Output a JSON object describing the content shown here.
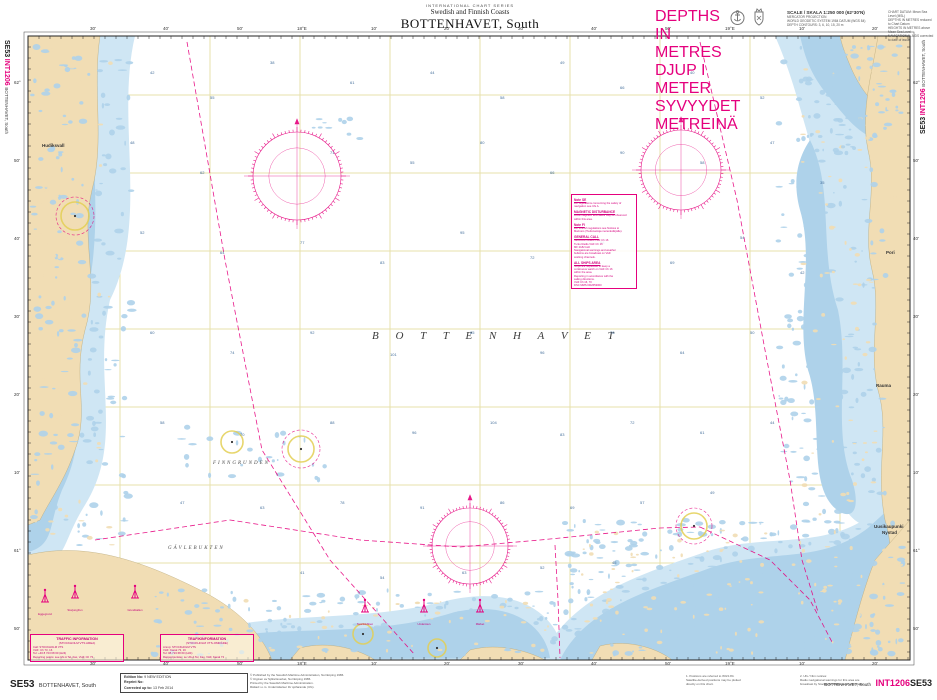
{
  "colors": {
    "magenta": "#e5007d",
    "land": "#f1ddb4",
    "shallow": "#aed2ea",
    "shallow_light": "#cfe6f4",
    "yellow": "#e3cf54",
    "graticule": "#e7e1ab",
    "sounding": "#46709c"
  },
  "page": {
    "top": {
      "series_line": "INTERNATIONAL CHART SERIES",
      "coasts_line": "Swedish and Finnish Coasts",
      "title": "BOTTENHAVET, South",
      "depths_note": [
        "DEPTHS IN METRES",
        "DJUP I METER",
        "SYVYYDET METREINÄ"
      ],
      "scale_title": "SCALE / SKALA 1:250 000 (62°30'N)",
      "scale_lines": [
        "MERCATOR PROJECTION",
        "WORLD GEODETIC SYSTEM 1984 DATUM (WGS 84)",
        "DEPTH CONTOURS: 3, 6, 10, 15, 20 m"
      ],
      "datum_lines": [
        "CHART DATUM: Mean Sea Level (MSL)",
        "DEPTHS IN METRES reduced to Chart Datum",
        "HEIGHTS IN METRES above Mean Sea Level",
        "NAVIGATIONAL AIDS corrected to date of issue"
      ]
    },
    "edge_left": {
      "id": "SE53",
      "int": "INT1206",
      "title": "BOTTENHAVET, South"
    },
    "edge_right": {
      "id": "SE53",
      "int": "INT1206",
      "title": "BOTTENHAVET, South"
    },
    "bottom": {
      "id": "SE53",
      "id_title": "BOTTENHAVET, South",
      "edition_rows": [
        [
          "Edition No:",
          "9 NEW EDITION"
        ],
        [
          "Reprint No:",
          ""
        ],
        [
          "Corrected up to:",
          "13 Feb 2014"
        ]
      ],
      "publisher_lines": [
        "© Published by the Swedish Maritime Administration, Norrköping 1986.",
        "© Utgiven av Sjöfartsverket, Norrköping 1986.",
        "Printed by the Swedish Maritime Administration.",
        "Rättad t.o.m. Underrättelser för sjöfarande (Ufs)."
      ],
      "right_notes_a": [
        "1. Positions are referred to WGS 84.",
        "Satellite-derived positions may be plotted",
        "directly on this chart."
      ],
      "right_notes_b": [
        "2. Ufs / Ntm notices:",
        "Radio navigational warnings for this area are",
        "broadcast by Stockholm Radio and Turku Radio."
      ],
      "title_small": "BOTTENHAVET, South",
      "int_label": "INT1206",
      "chart_label": "SE53"
    }
  },
  "chart": {
    "sea_label": "B O T T E N H A V E T",
    "labels": [
      {
        "t": "FINNGRUNDEN",
        "x": 213,
        "y": 461,
        "cls": "sea2"
      },
      {
        "t": "GÄVLEBUKTEN",
        "x": 168,
        "y": 546,
        "cls": "sea2"
      },
      {
        "t": "Hudiksvall",
        "x": 42,
        "y": 143,
        "cls": "town"
      },
      {
        "t": "Pori",
        "x": 886,
        "y": 250,
        "cls": "town"
      },
      {
        "t": "Rauma",
        "x": 876,
        "y": 383,
        "cls": "town"
      },
      {
        "t": "Uusikaupunki",
        "x": 874,
        "y": 524,
        "cls": "town"
      },
      {
        "t": "Nystad",
        "x": 882,
        "y": 530,
        "cls": "town"
      }
    ],
    "notes": {
      "x": 571,
      "y": 194,
      "sections": [
        {
          "title": "Note SE",
          "lines": [
            "For regulations concerning the safety of",
            "navigation see Ufs A."
          ]
        },
        {
          "title": "MAGNETIC DISTURBANCE",
          "lines": [
            "Local magnetic anomalies may be observed",
            "within this area."
          ]
        },
        {
          "title": "Note FI",
          "lines": [
            "For Finnish regulations see Notices to",
            "Mariners (Tiedonantoja merenkulkijoille)."
          ]
        },
        {
          "title": "GENERAL CALL",
          "lines": [
            "Stockholm Radio VHF Ch 16",
            "Turku Radio VHF Ch 16",
            "MF 2182 kHz",
            "Navigational warnings and weather",
            "bulletins are broadcast on VHF",
            "working channels."
          ]
        },
        {
          "title": "ALL SHIPS AREA",
          "lines": [
            "Ships are requested to keep a",
            "continuous watch on VHF Ch 16",
            "within the area.",
            "Reporting in accordance with the",
            "sailing directions.",
            "VHF Ch 16, 70",
            "DSC MMSI 002653000"
          ]
        }
      ]
    },
    "traffic_boxes": [
      {
        "x": 30,
        "y": 634,
        "title": "TRAFFIC INFORMATION",
        "subtitle": "(STOCKHOLM VTS AREA)",
        "rows": [
          "Call:  STOCKHOLM VTS",
          "VHF:  Ch 73, 16",
          "Tel:  +46 8 723 68 60   (H24)",
          "Reporting points: see Ufs A Tel, Fax, VHF, Ch 73"
        ]
      },
      {
        "x": 160,
        "y": 634,
        "title": "TRAFIKINFORMATION",
        "subtitle": "(STOCKHOLM VTS-OMRÅDE)",
        "rows": [
          "Anrop:  STOCKHOLM VTS",
          "VHF:  Kanal 73, 16",
          "Tel:  08-723 68 60   (H24)",
          "Rapportpunkter: se Ufs A Tel, Fax, VHF, Kanal 73"
        ]
      }
    ],
    "legend_beacons": [
      {
        "x": 45,
        "y": 588,
        "label": "Eggegrund"
      },
      {
        "x": 75,
        "y": 584,
        "label": "Storjungfrun"
      },
      {
        "x": 135,
        "y": 584,
        "label": "Grundkallen"
      },
      {
        "x": 365,
        "y": 598,
        "label": "Svartklubben"
      },
      {
        "x": 424,
        "y": 598,
        "label": "Understen"
      },
      {
        "x": 480,
        "y": 598,
        "label": "Märket"
      }
    ],
    "grad_top": [
      {
        "x": 90,
        "t": "30'"
      },
      {
        "x": 163,
        "t": "40'"
      },
      {
        "x": 237,
        "t": "50'"
      },
      {
        "x": 297,
        "t": "18°E"
      },
      {
        "x": 371,
        "t": "10'"
      },
      {
        "x": 444,
        "t": "20'"
      },
      {
        "x": 518,
        "t": "30'"
      },
      {
        "x": 591,
        "t": "40'"
      },
      {
        "x": 665,
        "t": "50'"
      },
      {
        "x": 725,
        "t": "19°E"
      },
      {
        "x": 799,
        "t": "10'"
      },
      {
        "x": 872,
        "t": "20'"
      }
    ],
    "grad_bottom": [
      {
        "x": 90,
        "t": "30'"
      },
      {
        "x": 163,
        "t": "40'"
      },
      {
        "x": 237,
        "t": "50'"
      },
      {
        "x": 297,
        "t": "18°E"
      },
      {
        "x": 371,
        "t": "10'"
      },
      {
        "x": 444,
        "t": "20'"
      },
      {
        "x": 518,
        "t": "30'"
      },
      {
        "x": 591,
        "t": "40'"
      },
      {
        "x": 665,
        "t": "50'"
      },
      {
        "x": 725,
        "t": "19°E"
      },
      {
        "x": 799,
        "t": "10'"
      },
      {
        "x": 872,
        "t": "20'"
      }
    ],
    "grad_left": [
      {
        "y": 80,
        "t": "62°"
      },
      {
        "y": 158,
        "t": "50'"
      },
      {
        "y": 236,
        "t": "40'"
      },
      {
        "y": 314,
        "t": "30'"
      },
      {
        "y": 392,
        "t": "20'"
      },
      {
        "y": 470,
        "t": "10'"
      },
      {
        "y": 548,
        "t": "61°"
      },
      {
        "y": 626,
        "t": "50'"
      }
    ],
    "grad_right": [
      {
        "y": 80,
        "t": "62°"
      },
      {
        "y": 158,
        "t": "50'"
      },
      {
        "y": 236,
        "t": "40'"
      },
      {
        "y": 314,
        "t": "30'"
      },
      {
        "y": 392,
        "t": "20'"
      },
      {
        "y": 470,
        "t": "10'"
      },
      {
        "y": 548,
        "t": "61°"
      },
      {
        "y": 626,
        "t": "50'"
      }
    ],
    "soundings": [
      [
        150,
        70,
        42
      ],
      [
        210,
        95,
        55
      ],
      [
        270,
        60,
        38
      ],
      [
        350,
        80,
        61
      ],
      [
        430,
        70,
        44
      ],
      [
        500,
        95,
        58
      ],
      [
        560,
        60,
        49
      ],
      [
        620,
        85,
        66
      ],
      [
        690,
        70,
        40
      ],
      [
        760,
        95,
        52
      ],
      [
        130,
        140,
        48
      ],
      [
        200,
        170,
        62
      ],
      [
        330,
        150,
        71
      ],
      [
        410,
        160,
        55
      ],
      [
        480,
        140,
        80
      ],
      [
        550,
        170,
        66
      ],
      [
        620,
        150,
        90
      ],
      [
        700,
        160,
        58
      ],
      [
        770,
        140,
        47
      ],
      [
        820,
        180,
        35
      ],
      [
        140,
        230,
        52
      ],
      [
        220,
        250,
        64
      ],
      [
        300,
        240,
        77
      ],
      [
        380,
        260,
        83
      ],
      [
        460,
        230,
        95
      ],
      [
        530,
        255,
        72
      ],
      [
        600,
        240,
        88
      ],
      [
        670,
        260,
        69
      ],
      [
        740,
        235,
        54
      ],
      [
        800,
        270,
        42
      ],
      [
        150,
        330,
        60
      ],
      [
        230,
        350,
        74
      ],
      [
        310,
        330,
        92
      ],
      [
        390,
        352,
        101
      ],
      [
        470,
        330,
        85
      ],
      [
        540,
        350,
        96
      ],
      [
        610,
        330,
        78
      ],
      [
        680,
        350,
        64
      ],
      [
        750,
        330,
        50
      ],
      [
        160,
        420,
        58
      ],
      [
        240,
        432,
        70
      ],
      [
        330,
        420,
        88
      ],
      [
        412,
        430,
        96
      ],
      [
        490,
        420,
        104
      ],
      [
        560,
        432,
        83
      ],
      [
        630,
        420,
        72
      ],
      [
        700,
        430,
        61
      ],
      [
        770,
        420,
        44
      ],
      [
        180,
        500,
        47
      ],
      [
        260,
        505,
        63
      ],
      [
        340,
        500,
        78
      ],
      [
        420,
        505,
        91
      ],
      [
        500,
        500,
        86
      ],
      [
        570,
        505,
        69
      ],
      [
        640,
        500,
        57
      ],
      [
        710,
        490,
        49
      ],
      [
        300,
        570,
        41
      ],
      [
        380,
        575,
        54
      ],
      [
        462,
        570,
        63
      ],
      [
        540,
        565,
        52
      ],
      [
        612,
        560,
        45
      ]
    ]
  },
  "map": {
    "routes": [
      {
        "pts": [
          [
            187,
            42
          ],
          [
            225,
            260
          ],
          [
            262,
            450
          ],
          [
            330,
            560
          ],
          [
            415,
            655
          ]
        ]
      },
      {
        "pts": [
          [
            700,
            42
          ],
          [
            737,
            200
          ],
          [
            765,
            350
          ],
          [
            790,
            480
          ],
          [
            802,
            560
          ],
          [
            818,
            612
          ]
        ]
      },
      {
        "pts": [
          [
            95,
            540
          ],
          [
            230,
            520
          ],
          [
            360,
            540
          ],
          [
            460,
            547
          ],
          [
            540,
            540
          ],
          [
            660,
            528
          ],
          [
            700,
            527
          ]
        ]
      },
      {
        "pts": [
          [
            700,
            527
          ],
          [
            770,
            560
          ],
          [
            810,
            600
          ],
          [
            832,
            642
          ]
        ]
      },
      {
        "pts": [
          [
            555,
            545
          ],
          [
            558,
            600
          ],
          [
            560,
            658
          ]
        ]
      }
    ],
    "light_circles": [
      [
        75,
        216,
        14
      ],
      [
        232,
        442,
        11
      ],
      [
        301,
        449,
        13
      ],
      [
        694,
        526,
        13
      ],
      [
        363,
        634,
        10
      ],
      [
        437,
        648,
        9
      ]
    ],
    "dash_circles": [
      [
        75,
        216,
        19
      ],
      [
        301,
        449,
        19
      ],
      [
        694,
        526,
        18
      ]
    ],
    "compasses": [
      [
        297,
        176,
        44
      ],
      [
        681,
        170,
        40
      ],
      [
        470,
        546,
        38
      ]
    ]
  }
}
